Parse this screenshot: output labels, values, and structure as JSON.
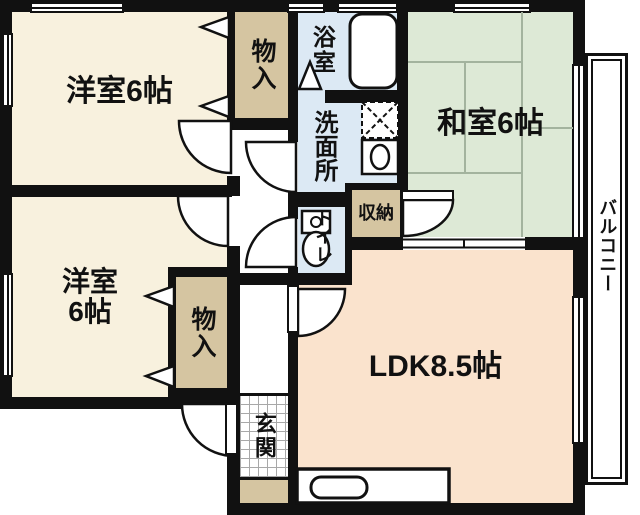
{
  "palette": {
    "wall": "#111111",
    "western_room": "#f8f1de",
    "closet_tan": "#d5c5a1",
    "wet_area_blue": "#dce9f4",
    "tatami_green": "#dde9d6",
    "ldk_peach": "#fae3cd",
    "tatami_line": "#a3b39e",
    "fixture_white": "#ffffff"
  },
  "rooms": {
    "western1": {
      "label": "洋室6帖"
    },
    "western2": {
      "label_line1": "洋室",
      "label_line2": "6帖"
    },
    "japanese": {
      "label": "和室6帖"
    },
    "ldk": {
      "label": "LDK8.5帖"
    },
    "bath": {
      "label": "浴室"
    },
    "washroom": {
      "label": "洗面所"
    },
    "toilet": {
      "label": "トイレ"
    },
    "storage_top": {
      "label": "物入"
    },
    "storage_bottom": {
      "label": "物入"
    },
    "closet": {
      "label": "収納"
    },
    "entrance": {
      "label": "玄関"
    },
    "balcony": {
      "label": "バルコニー"
    }
  }
}
